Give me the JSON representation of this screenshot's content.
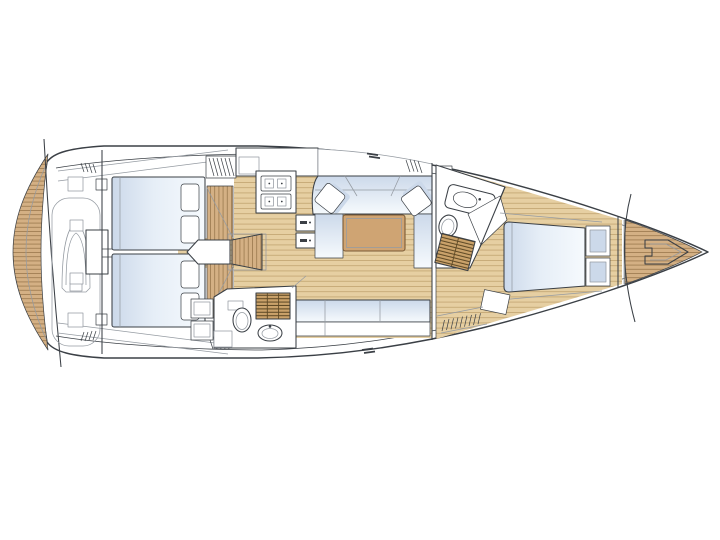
{
  "meta": {
    "title": "Sailing yacht interior layout floor plan, bow pointing right",
    "type": "boat-floor-plan",
    "orientation": {
      "bow": "right",
      "stern": "left"
    }
  },
  "colors": {
    "background": "#ffffff",
    "line": "#3b4046",
    "line_light": "#959ba2",
    "teak": "#d4b084",
    "teak_line": "#96744a",
    "floor": "#e6cfa2",
    "floor_line": "#c2a471",
    "cushion": "#ccd9ea",
    "bed_hi": "#f6fafd",
    "table": "#cfa473",
    "table_edge": "#7a5a35",
    "louvre": "#caa26a",
    "louvre_slat": "#5f4a26",
    "fixture": "#ffffff"
  },
  "areas": [
    "swim-platform",
    "tender-garage",
    "aft-cabin-starboard",
    "aft-cabin-port",
    "companionway-stairs",
    "galley",
    "stove",
    "refrigerator-drawers",
    "dinette-settee",
    "saloon-table",
    "scatter-pillows",
    "saloon-bench",
    "aft-head",
    "forward-head",
    "forward-cabin",
    "island-bed",
    "anchor-locker"
  ]
}
